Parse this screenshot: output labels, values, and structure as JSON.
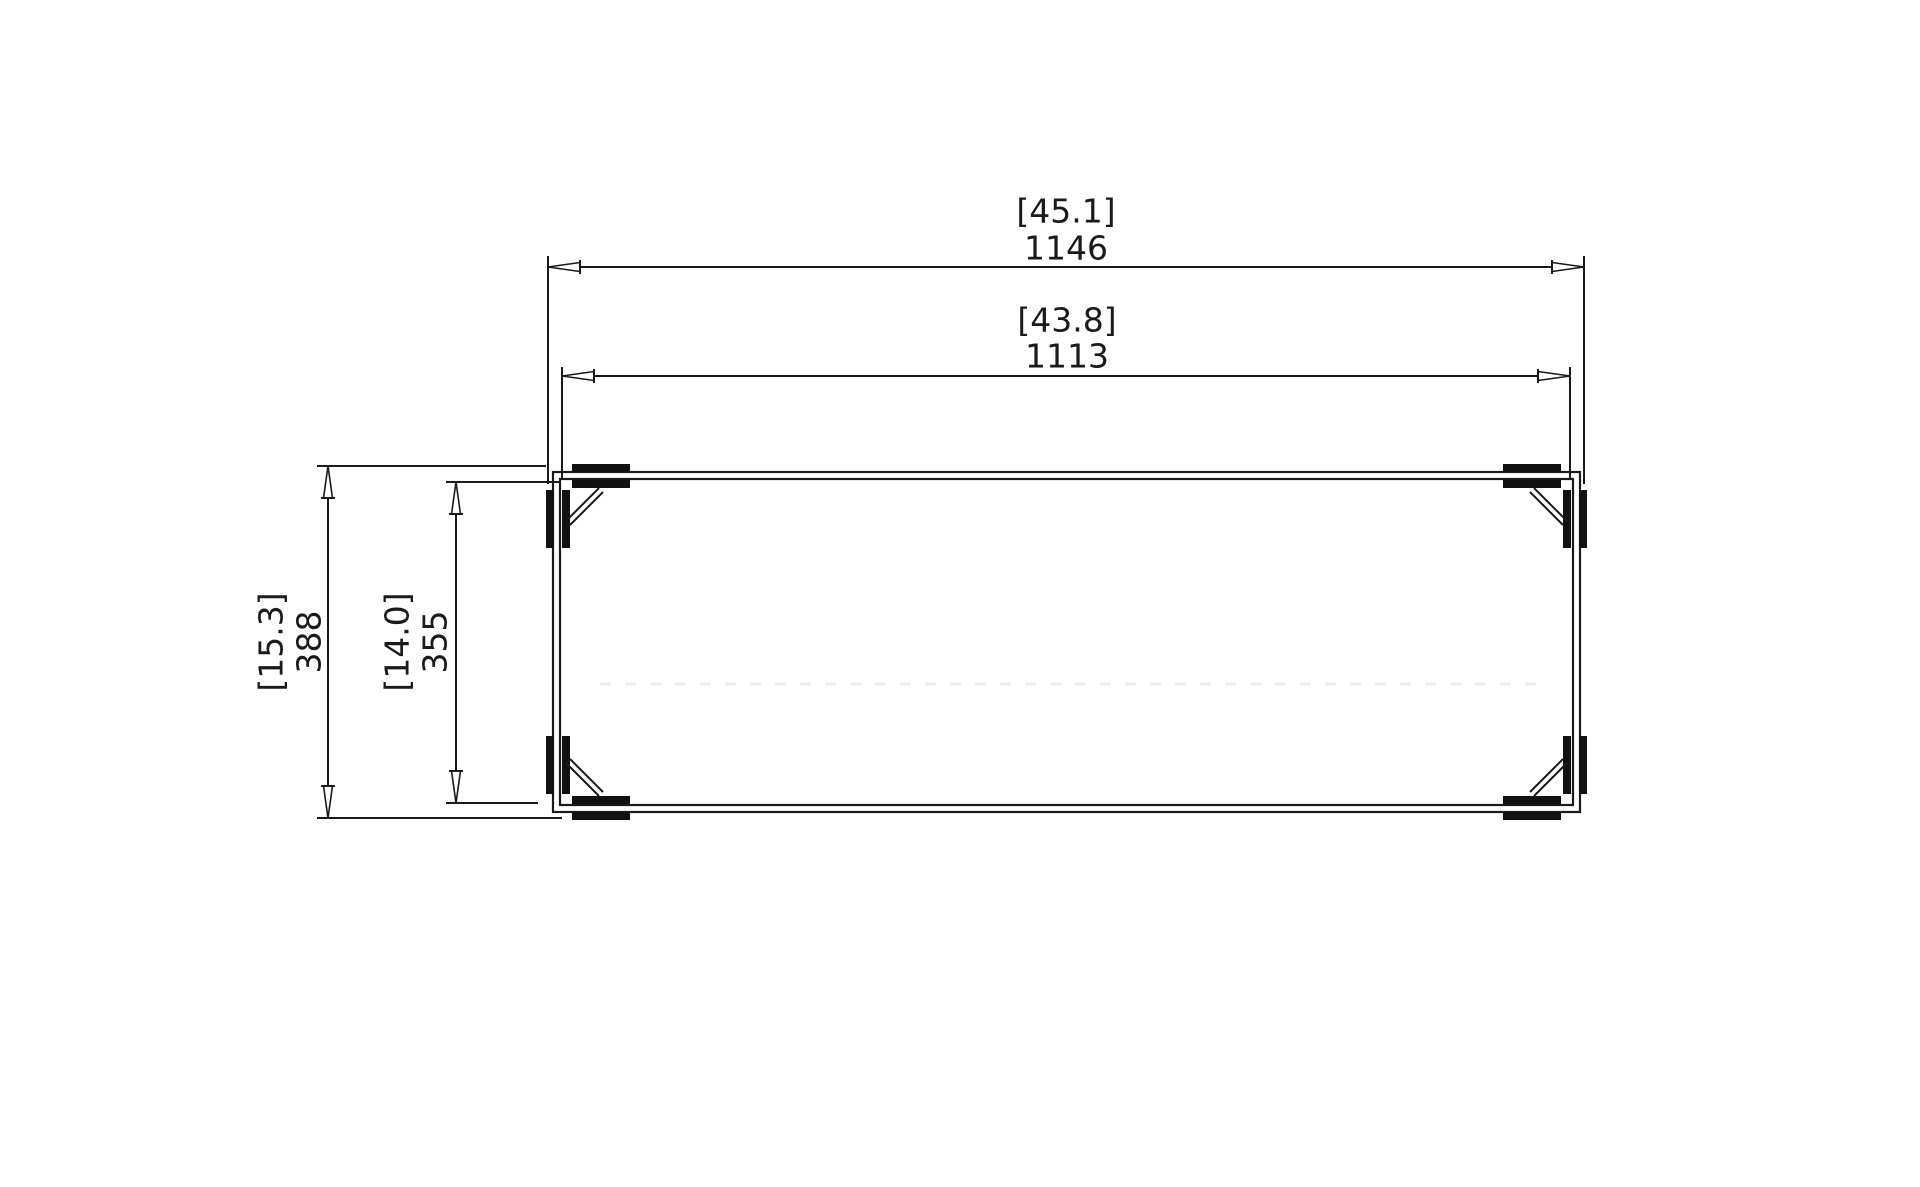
{
  "colors": {
    "background": "#ffffff",
    "line": "#1a1a1a"
  },
  "dimensions": {
    "overall_width": {
      "imperial_bracket": "[45.1]",
      "metric": "1146"
    },
    "inner_width": {
      "imperial_bracket": "[43.8]",
      "metric": "1113"
    },
    "overall_depth": {
      "imperial_bracket": "[15.3]",
      "metric": "388"
    },
    "inner_depth": {
      "imperial_bracket": "[14.0]",
      "metric": "355"
    }
  }
}
